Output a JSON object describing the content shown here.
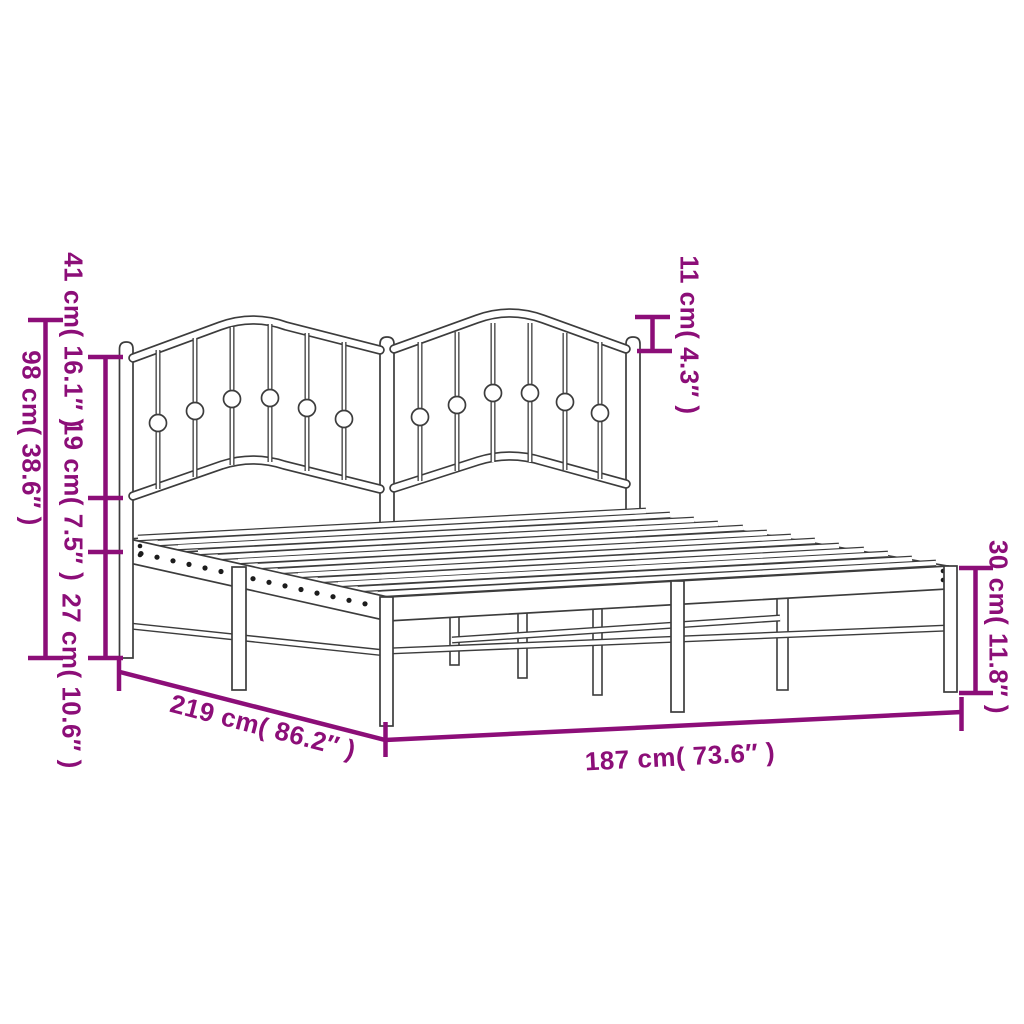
{
  "diagram": {
    "title": "Metal bed frame with headboard — dimension diagram",
    "background_color": "#ffffff",
    "accent_color": "#8C0E78",
    "line_art_color": "#3C3C3C",
    "dimensions": [
      {
        "id": "total-height",
        "label": "98 cm( 38.6″ )",
        "value_cm": 98,
        "value_in": 38.6,
        "orientation": "vertical",
        "location": "left-outer"
      },
      {
        "id": "headboard-upper-height",
        "label": "41 cm( 16.1″ )",
        "value_cm": 41,
        "value_in": 16.1,
        "orientation": "vertical",
        "location": "left-inner-top"
      },
      {
        "id": "headboard-middle-height",
        "label": "19 cm( 7.5″ )",
        "value_cm": 19,
        "value_in": 7.5,
        "orientation": "vertical",
        "location": "left-inner-middle"
      },
      {
        "id": "headboard-lower-height",
        "label": "27 cm( 10.6″ )",
        "value_cm": 27,
        "value_in": 10.6,
        "orientation": "vertical",
        "location": "left-inner-bottom"
      },
      {
        "id": "headboard-wave-height",
        "label": "11 cm( 4.3″ )",
        "value_cm": 11,
        "value_in": 4.3,
        "orientation": "vertical",
        "location": "top-right"
      },
      {
        "id": "frame-height",
        "label": "30 cm( 11.8″ )",
        "value_cm": 30,
        "value_in": 11.8,
        "orientation": "vertical",
        "location": "right"
      },
      {
        "id": "bed-length",
        "label": "219 cm( 86.2″ )",
        "value_cm": 219,
        "value_in": 86.2,
        "orientation": "diagonal",
        "location": "bottom-left"
      },
      {
        "id": "bed-width",
        "label": "187 cm( 73.6″ )",
        "value_cm": 187,
        "value_in": 73.6,
        "orientation": "horizontal",
        "location": "bottom"
      }
    ]
  }
}
